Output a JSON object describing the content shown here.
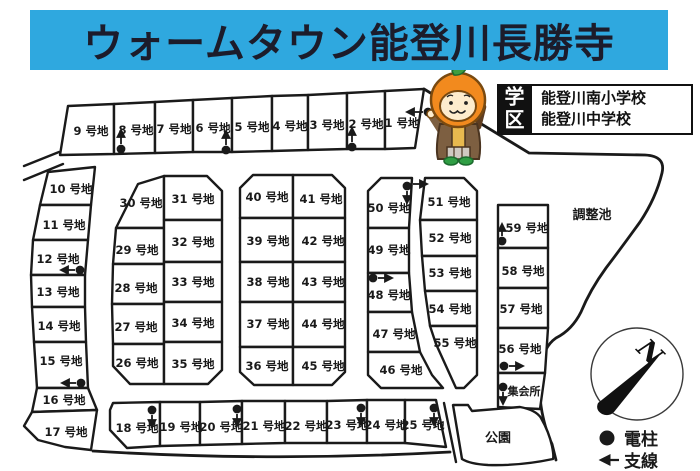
{
  "title": {
    "text": "ウォームタウン能登川長勝寺"
  },
  "colors": {
    "banner_bg": "#2fa8df",
    "banner_fg": "#1c1c2b",
    "line": "#1a1a1a"
  },
  "school_district": {
    "badge": "学区",
    "schools": [
      "能登川南小学校",
      "能登川中学校"
    ]
  },
  "icons": {
    "mascot": "persimmon-character",
    "legend_pole": "filled-circle",
    "legend_wire": "left-arrow",
    "compass": "north-needle"
  },
  "map": {
    "pond_label": "調整池",
    "park_label": "公園",
    "hall_label": "集会所",
    "compass_n": "N",
    "legend": {
      "pole_label": "電柱",
      "wire_label": "支線"
    },
    "lots": [
      "1 号地",
      "2 号地",
      "3 号地",
      "4 号地",
      "5 号地",
      "6 号地",
      "7 号地",
      "8 号地",
      "9 号地",
      "10 号地",
      "11 号地",
      "12 号地",
      "13 号地",
      "14 号地",
      "15 号地",
      "16 号地",
      "17 号地",
      "18 号地",
      "19 号地",
      "20 号地",
      "21 号地",
      "22 号地",
      "23 号地",
      "24 号地",
      "25 号地",
      "26 号地",
      "27 号地",
      "28 号地",
      "29 号地",
      "30 号地",
      "31 号地",
      "32 号地",
      "33 号地",
      "34 号地",
      "35 号地",
      "36 号地",
      "37 号地",
      "38 号地",
      "39 号地",
      "40 号地",
      "41 号地",
      "42 号地",
      "43 号地",
      "44 号地",
      "45 号地",
      "46 号地",
      "47 号地",
      "48 号地",
      "49 号地",
      "50 号地",
      "51 号地",
      "52 号地",
      "53 号地",
      "54 号地",
      "55 号地",
      "56 号地",
      "57 号地",
      "58 号地",
      "59 号地"
    ]
  }
}
